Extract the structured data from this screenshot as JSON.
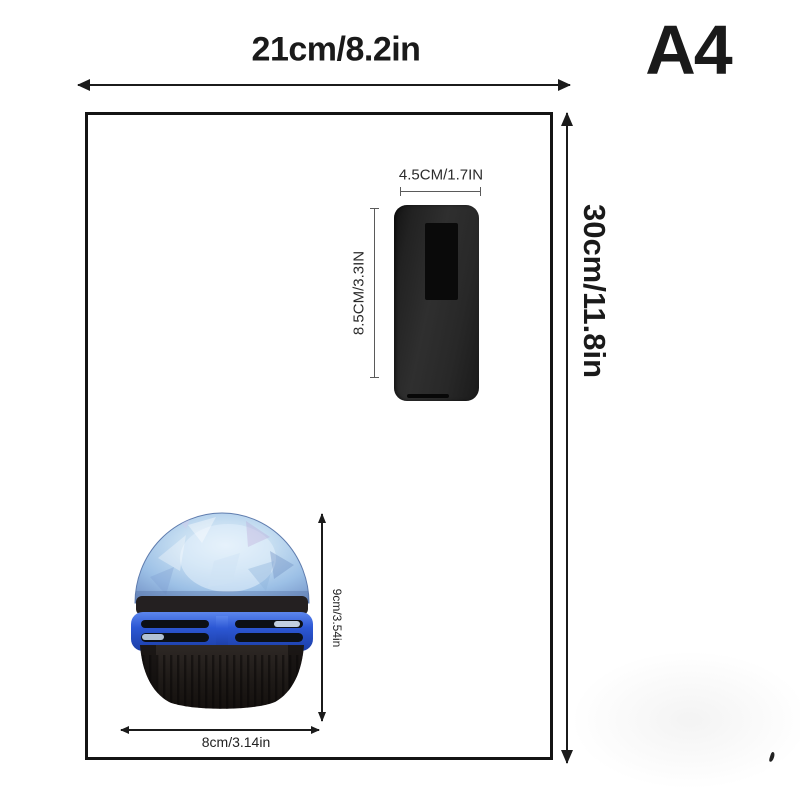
{
  "paper": {
    "name": "A4",
    "width_label": "21cm/8.2in",
    "height_label": "30cm/11.8in"
  },
  "remote": {
    "width_label": "4.5CM/1.7IN",
    "height_label": "8.5CM/3.3IN"
  },
  "lamp": {
    "height_label": "9cm/3.54in",
    "width_label": "8cm/3.14in"
  },
  "colors": {
    "ink": "#1b1b1b",
    "paper_border": "#141414",
    "paper_fill": "#ffffff",
    "remote_body": "#282828",
    "remote_screen": "#0a0a0a",
    "lamp_dome": "#a9c9e9",
    "lamp_ring": "#2c57d4",
    "lamp_base": "#1a1614"
  }
}
